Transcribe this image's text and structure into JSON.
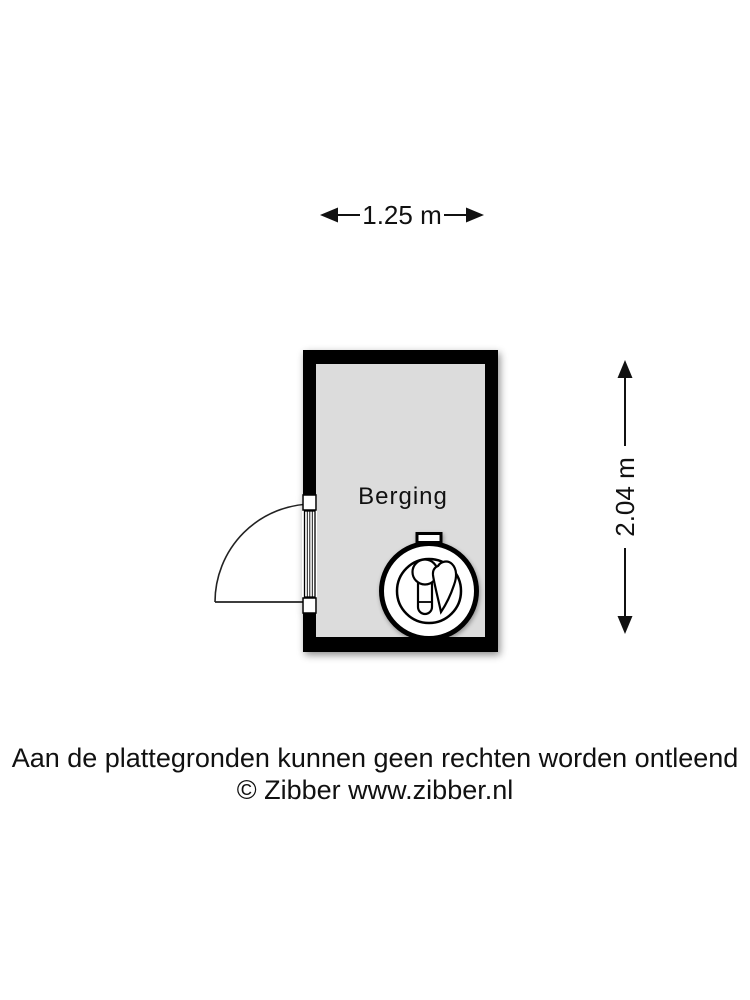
{
  "plan": {
    "room": {
      "label": "Berging",
      "wall_color": "#000000",
      "floor_color": "#dcdcdc"
    },
    "dimensions": {
      "width_label": "1.25 m",
      "height_label": "2.04 m"
    },
    "icons": {
      "appliance": "boiler-icon",
      "door": "door-swing-icon",
      "width_arrows": [
        "arrow-left-icon",
        "arrow-right-icon"
      ],
      "height_arrows": [
        "arrow-up-icon",
        "arrow-down-icon"
      ]
    }
  },
  "footer": {
    "disclaimer": "Aan de plattegronden kunnen geen rechten worden ontleend",
    "copyright": "© Zibber www.zibber.nl"
  }
}
